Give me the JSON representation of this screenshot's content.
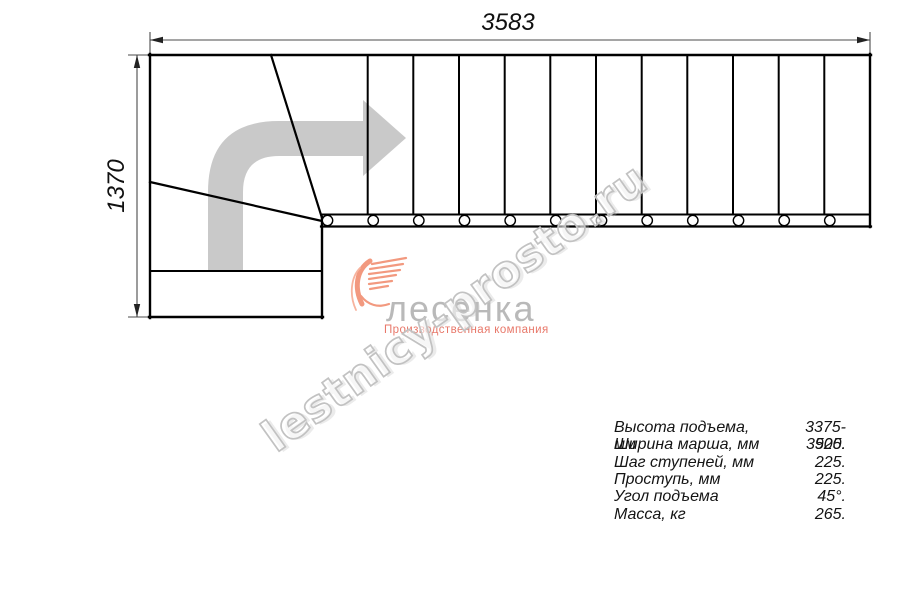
{
  "drawing": {
    "dimension_width_mm": "3583",
    "dimension_height_mm": "1370",
    "tread_count": 12
  },
  "specs": {
    "rows": [
      {
        "label": "Высота подъема, мм",
        "value": "3375-3525."
      },
      {
        "label": "Ширина марша, мм",
        "value": "900."
      },
      {
        "label": "Шаг ступеней, мм",
        "value": "225."
      },
      {
        "label": "Проступь, мм",
        "value": "225."
      },
      {
        "label": "Угол подъема",
        "value": "45°."
      },
      {
        "label": "Масса, кг",
        "value": "265."
      }
    ]
  },
  "watermark": {
    "text": "lestnicy-prosto.ru"
  },
  "logo": {
    "name": "лесенка",
    "tagline": "Производственная компания"
  },
  "colors": {
    "line": "#000000",
    "dimension": "#4b4b4b",
    "direction_arrow": "#c9c9c9",
    "watermark_outline": "#c2c2c2",
    "logo_accent": "#f2997f",
    "logo_text": "#b9b9b9",
    "logo_tagline": "#e8786a"
  }
}
